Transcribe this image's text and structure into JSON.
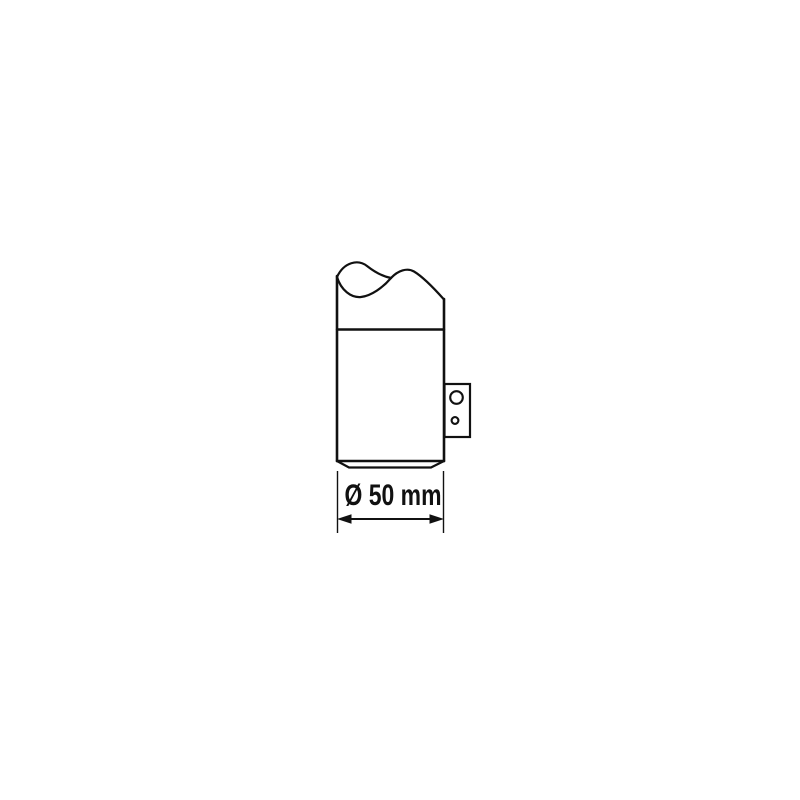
{
  "page": {
    "background_color": "#ffffff"
  },
  "drawing": {
    "kind": "technical-line-drawing",
    "subject": "cylindrical part (broken-off top) with side mounting bracket and diameter dimension",
    "line_color": "#111111",
    "dimension": {
      "label": "Ø 50 mm",
      "symbol": "Ø",
      "value": "50",
      "unit": "mm"
    },
    "bracket": {
      "hole_count": 2
    }
  }
}
